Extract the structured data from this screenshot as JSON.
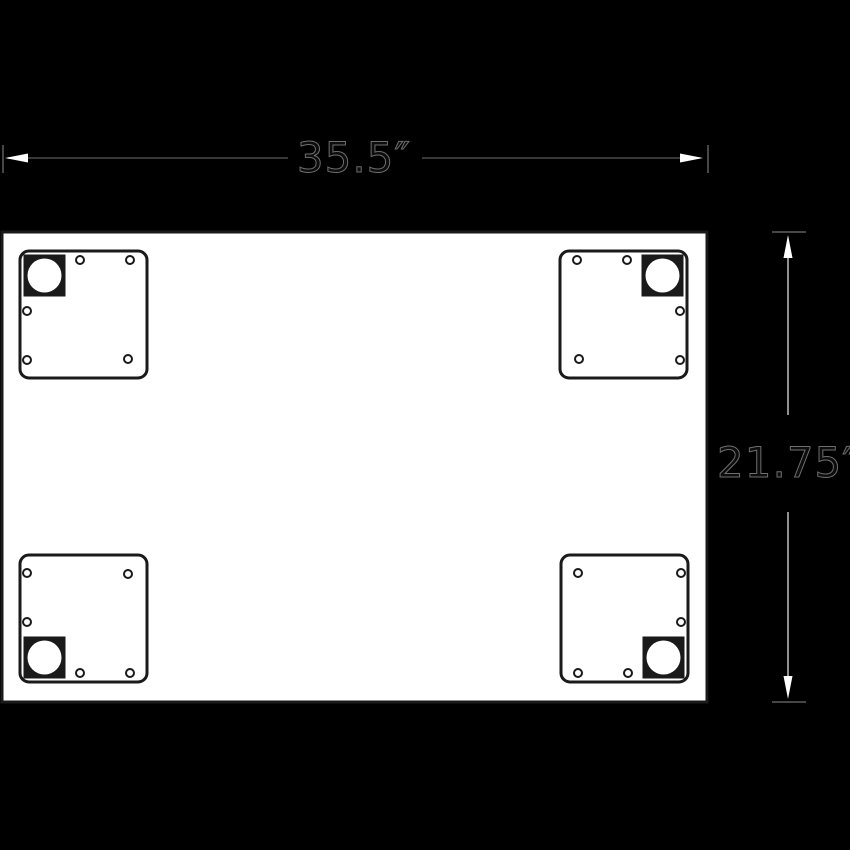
{
  "drawing": {
    "width_label": "35.5″",
    "height_label": "21.75″"
  },
  "colors": {
    "background": "#000000",
    "panel": "#ffffff",
    "line": "#1a1a1a",
    "dim_line_h": "#383838",
    "dim_line_v": "#8f8f8f",
    "extension_tick": "#464646",
    "arrowhead": "#ffffff",
    "dim_text_fill": "#0d0d0d",
    "dim_text_stroke": "#6e6e6e"
  }
}
